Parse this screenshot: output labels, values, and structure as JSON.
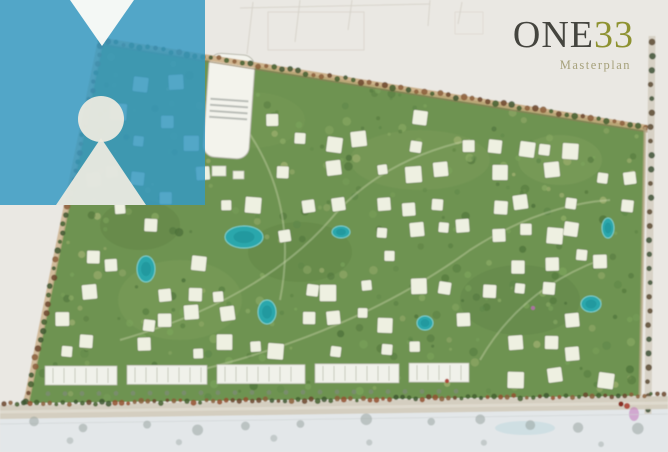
{
  "branding": {
    "title_main": "ONE",
    "title_number": "33",
    "subtitle": "Masterplan",
    "title_color": "#45453f",
    "number_color": "#8e9231",
    "subtitle_color": "#a6a17b"
  },
  "logo": {
    "name": "person-pin-logo",
    "square_color": "#3598c2",
    "notch_color": "#fbfbf7",
    "glyph_color": "#eceadf"
  },
  "map": {
    "outside_top": "#eae8e3",
    "outside_bottom": "#e3e7e9",
    "site_green": "#6e9351",
    "villa_white": "#eef0e1",
    "pool_teal": "#2ba7ac",
    "pool_deep": "#1f8f96",
    "road_tan": "#c9aa7e",
    "road_gray": "#d6d0c4",
    "tree_green": "#44602f",
    "tree_brown": "#6b452c",
    "tree_shadow": "#93a09b",
    "strip_building": "#f0f1ea",
    "accent_magenta": "#c06ab8",
    "accent_red": "#a93b2c",
    "sketch_line": "#d7d3ca"
  }
}
